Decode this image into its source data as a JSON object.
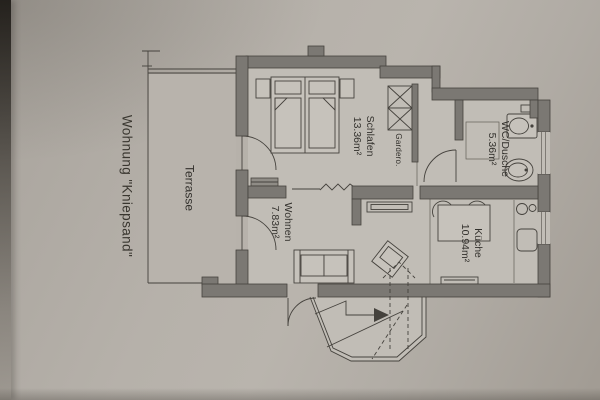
{
  "plan": {
    "title": "Wohnung \"Kniepsand\"",
    "labels": {
      "terrasse": {
        "name": "Terrasse"
      },
      "schlafen": {
        "name": "Schlafen",
        "area": "13.36m²"
      },
      "garderobe": {
        "name": "Gardero."
      },
      "wc": {
        "name": "WC/Dusche",
        "area": "5.36m²"
      },
      "wohnen": {
        "name": "Wohnen",
        "area": "7.83m²"
      },
      "kueche": {
        "name": "Küche",
        "area": "10.94m²"
      }
    },
    "symbols": [
      "double-bed",
      "nightstand",
      "wardrobe",
      "door-swing",
      "toilet",
      "washbasin",
      "shower-tray",
      "dining-table",
      "chair",
      "cooktop",
      "kitchen-sink",
      "sofa",
      "armchair",
      "sideboard",
      "radiator",
      "wall-break",
      "entrance-bay",
      "stairs-arrow",
      "roof-dashed-outline",
      "terrace-railing",
      "window"
    ],
    "colors": {
      "paper": "#b1aca5",
      "room": "#c1bdb6",
      "wall": "#7b7873",
      "line": "#45423d",
      "text": "#33312d",
      "page_edge": "#2f2c28"
    }
  }
}
